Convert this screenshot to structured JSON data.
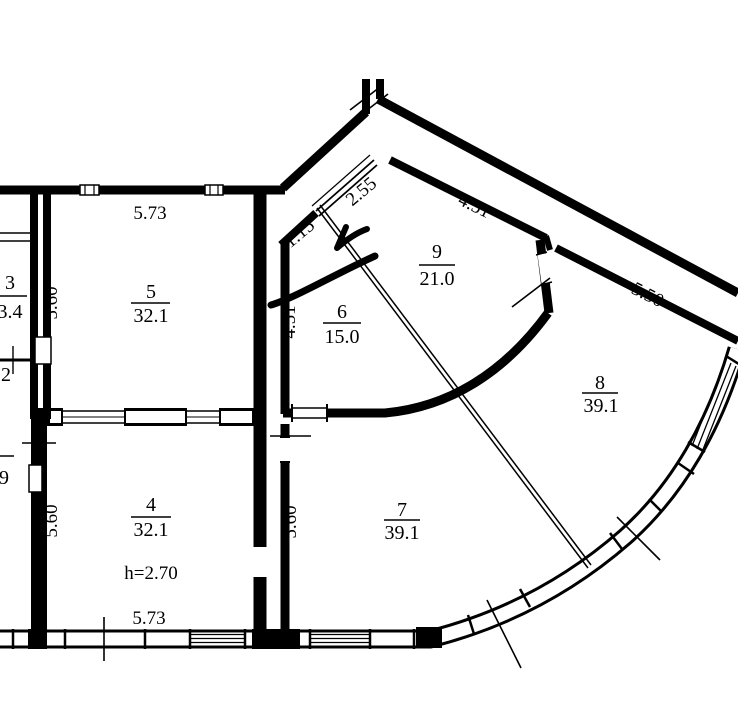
{
  "colors": {
    "ink": "#000000",
    "paper": "#ffffff"
  },
  "rooms": [
    {
      "name": "room-3",
      "num": "3",
      "num_x": 10,
      "num_y": 289,
      "bar_x1": -10,
      "bar_x2": 27,
      "bar_y": 296,
      "area": "3.4",
      "area_x": 10,
      "area_y": 318
    },
    {
      "name": "room-2",
      "num": "2",
      "num_x": 6,
      "num_y": 381
    },
    {
      "name": "room-lower-left",
      "bar_x1": -8,
      "bar_x2": 14,
      "bar_y": 456,
      "area": "9",
      "area_x": 4,
      "area_y": 484
    },
    {
      "name": "room-5",
      "num": "5",
      "num_x": 151,
      "num_y": 298,
      "bar_x1": 131,
      "bar_x2": 170,
      "bar_y": 303,
      "area": "32.1",
      "area_x": 151,
      "area_y": 322
    },
    {
      "name": "room-4",
      "num": "4",
      "num_x": 151,
      "num_y": 511,
      "bar_x1": 131,
      "bar_x2": 171,
      "bar_y": 517,
      "area": "32.1",
      "area_x": 151,
      "area_y": 536
    },
    {
      "name": "room-6",
      "num": "6",
      "num_x": 342,
      "num_y": 318,
      "bar_x1": 323,
      "bar_x2": 361,
      "bar_y": 323,
      "area": "15.0",
      "area_x": 342,
      "area_y": 343
    },
    {
      "name": "room-7",
      "num": "7",
      "num_x": 402,
      "num_y": 516,
      "bar_x1": 384,
      "bar_x2": 420,
      "bar_y": 520,
      "area": "39.1",
      "area_x": 402,
      "area_y": 539
    },
    {
      "name": "room-8",
      "num": "8",
      "num_x": 600,
      "num_y": 389,
      "bar_x1": 582,
      "bar_x2": 618,
      "bar_y": 393,
      "area": "39.1",
      "area_x": 601,
      "area_y": 412
    },
    {
      "name": "room-9",
      "num": "9",
      "num_x": 437,
      "num_y": 258,
      "bar_x1": 419,
      "bar_x2": 455,
      "bar_y": 265,
      "area": "21.0",
      "area_x": 437,
      "area_y": 285
    }
  ],
  "dimensions": [
    {
      "name": "dim-room5-width",
      "text": "5.73",
      "x": 150,
      "y": 219,
      "rot": 0
    },
    {
      "name": "dim-room5-depth",
      "text": "5.60",
      "x": 57,
      "y": 303,
      "rot": -90
    },
    {
      "name": "dim-room4-width",
      "text": "5.73",
      "x": 149,
      "y": 624,
      "rot": 0
    },
    {
      "name": "dim-room4-depth",
      "text": "5.60",
      "x": 57,
      "y": 521,
      "rot": -90
    },
    {
      "name": "dim-room7-depth",
      "text": "5.60",
      "x": 296,
      "y": 522,
      "rot": -90
    },
    {
      "name": "dim-room6-depth",
      "text": "4.51",
      "x": 295,
      "y": 322,
      "rot": -90
    },
    {
      "name": "dim-bay-lower",
      "text": "1.15",
      "x": 303,
      "y": 238,
      "rot": -40
    },
    {
      "name": "dim-bay-window",
      "text": "2.55",
      "x": 365,
      "y": 196,
      "rot": -40
    },
    {
      "name": "dim-room9-top",
      "text": "4.51",
      "x": 472,
      "y": 211,
      "rot": 26
    },
    {
      "name": "dim-room8-top",
      "text": "5.50",
      "x": 645,
      "y": 300,
      "rot": 27
    },
    {
      "name": "note-ceiling-height",
      "text": "h=2.70",
      "x": 151,
      "y": 579,
      "rot": 0
    }
  ]
}
